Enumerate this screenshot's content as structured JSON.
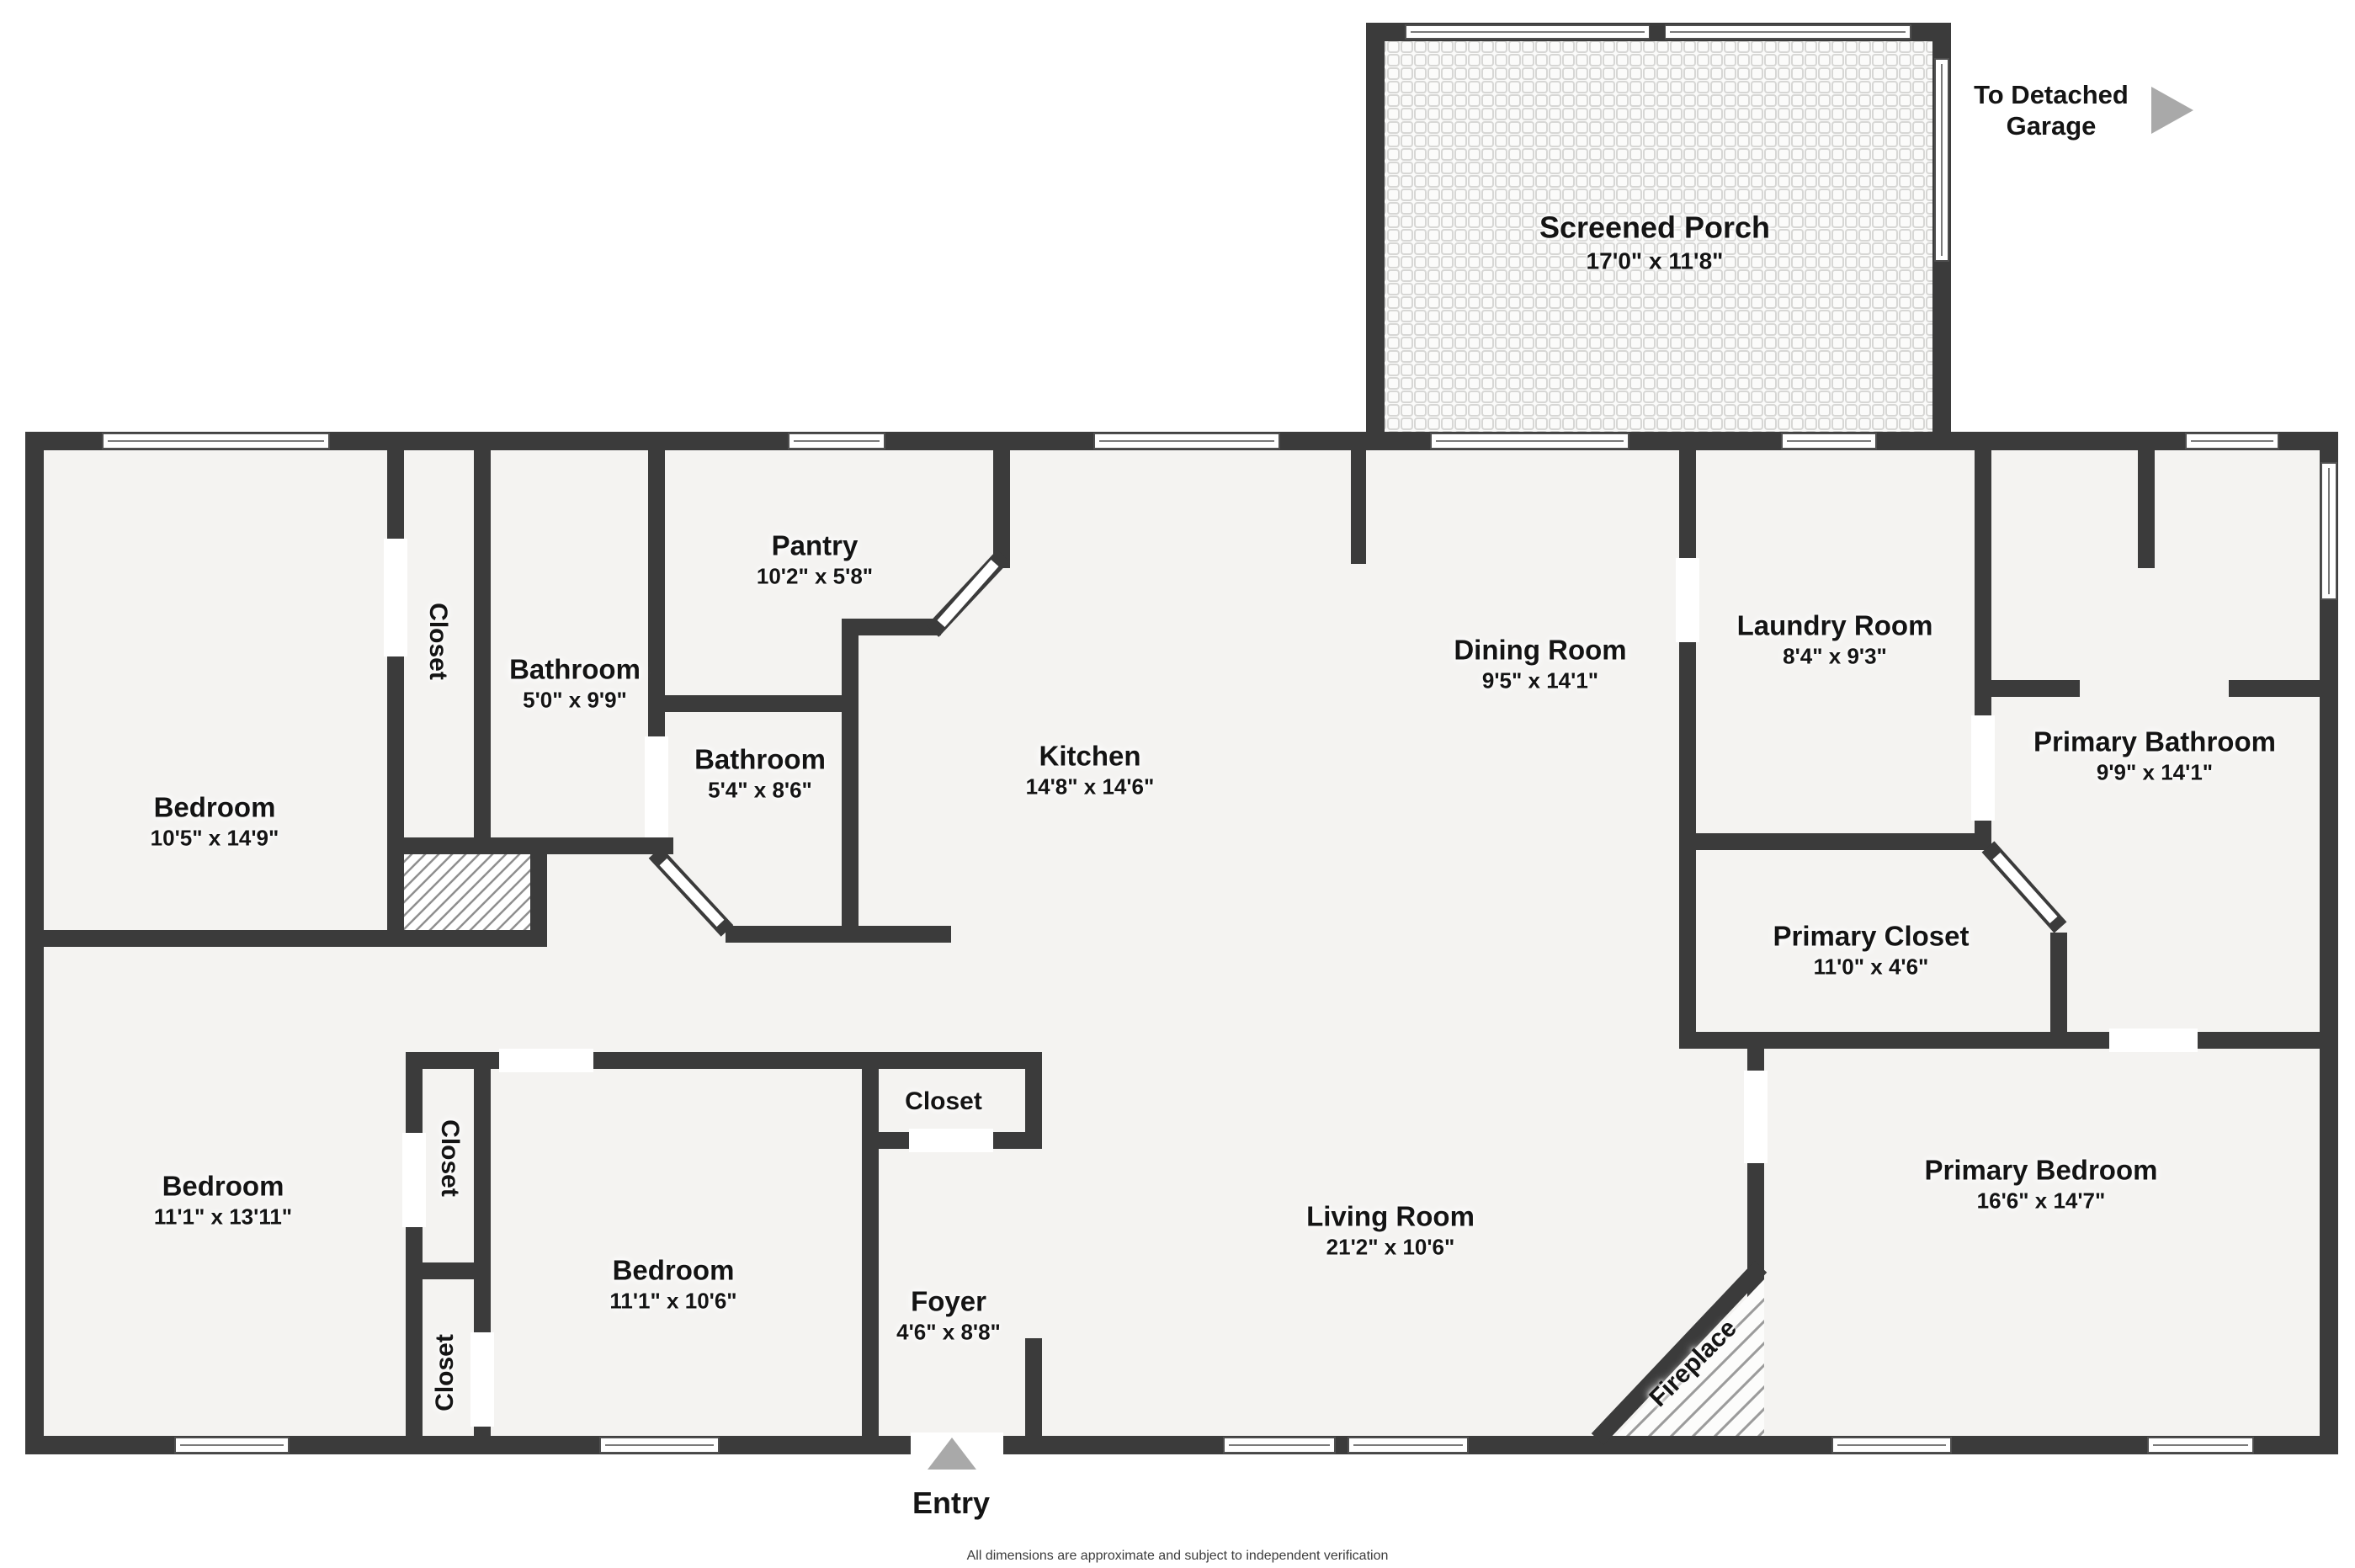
{
  "rooms": {
    "screened_porch": {
      "name": "Screened Porch",
      "dims": "17'0\" x 11'8\""
    },
    "bedroom_top_left": {
      "name": "Bedroom",
      "dims": "10'5\" x 14'9\""
    },
    "closet_top_left": {
      "name": "Closet"
    },
    "bathroom_top": {
      "name": "Bathroom",
      "dims": "5'0\" x 9'9\""
    },
    "pantry": {
      "name": "Pantry",
      "dims": "10'2\" x 5'8\""
    },
    "kitchen": {
      "name": "Kitchen",
      "dims": "14'8\" x 14'6\""
    },
    "bathroom_mid": {
      "name": "Bathroom",
      "dims": "5'4\" x 8'6\""
    },
    "dining_room": {
      "name": "Dining Room",
      "dims": "9'5\" x 14'1\""
    },
    "laundry_room": {
      "name": "Laundry Room",
      "dims": "8'4\" x 9'3\""
    },
    "primary_bathroom": {
      "name": "Primary Bathroom",
      "dims": "9'9\" x 14'1\""
    },
    "primary_closet": {
      "name": "Primary Closet",
      "dims": "11'0\" x 4'6\""
    },
    "bedroom_bottom_left": {
      "name": "Bedroom",
      "dims": "11'1\" x 13'11\""
    },
    "closet_col_top": {
      "name": "Closet"
    },
    "closet_col_bottom": {
      "name": "Closet"
    },
    "bedroom_bottom_mid": {
      "name": "Bedroom",
      "dims": "11'1\" x 10'6\""
    },
    "closet_foyer": {
      "name": "Closet"
    },
    "foyer": {
      "name": "Foyer",
      "dims": "4'6\" x 8'8\""
    },
    "living_room": {
      "name": "Living Room",
      "dims": "21'2\" x 10'6\""
    },
    "primary_bedroom": {
      "name": "Primary Bedroom",
      "dims": "16'6\" x 14'7\""
    },
    "fireplace": {
      "name": "Fireplace"
    }
  },
  "annotations": {
    "garage_note": "To Detached Garage",
    "entry_label": "Entry",
    "disclaimer": "All dimensions are approximate and subject to independent verification"
  },
  "colors": {
    "wall": "#3b3b3b",
    "floor": "#f4f3f1",
    "accent_gray": "#a9a9a9",
    "hatch_line": "#8f8f8f",
    "mesh_line": "#d7d7d5"
  }
}
